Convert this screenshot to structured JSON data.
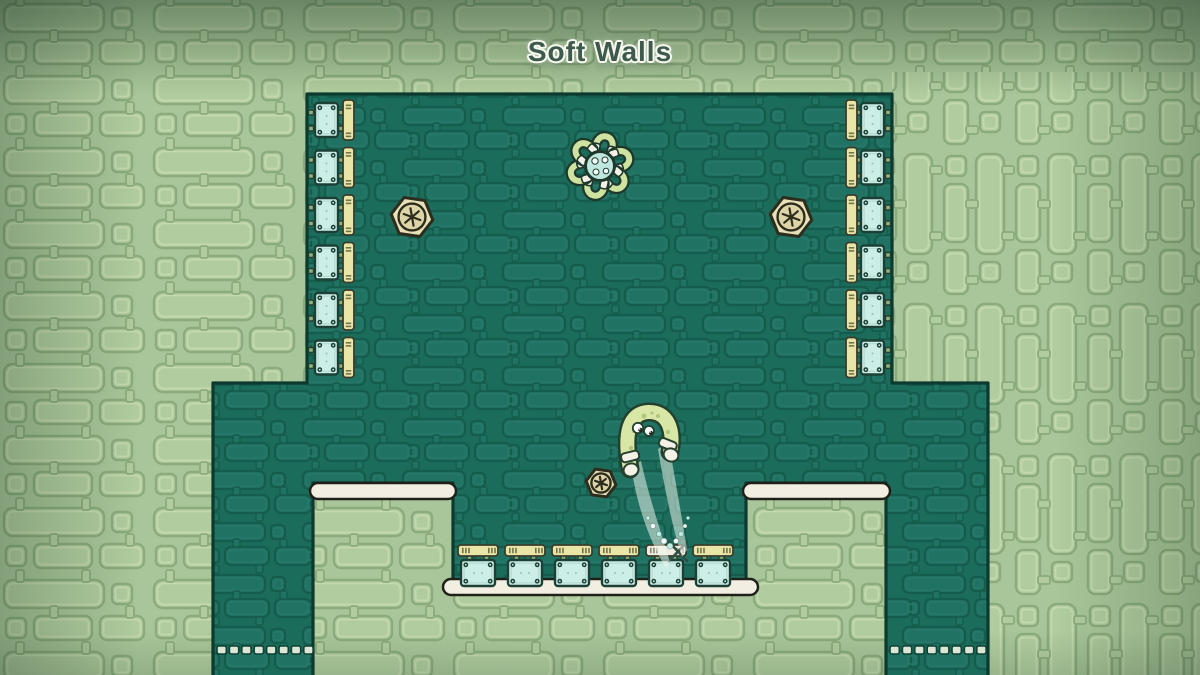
{
  "title": "Soft Walls",
  "colors": {
    "background": "#a9c69a",
    "field": "#1c6c5b",
    "outline_dark": "#0c3a2f",
    "block_fill": "#cdeee7",
    "block_border": "#1c4035",
    "tab_fill": "#e9e5a6",
    "spawn_tab_fill": "#edecdf",
    "platform_fill": "#f2efe2",
    "bolt_fill": "#e8e1b8",
    "character_body": "#d8e7a5",
    "title_color": "#3e5a4c"
  },
  "scene": {
    "left_wall_blocks": 6,
    "right_wall_blocks": 6,
    "floor_blocks": 6,
    "spawn_marker": {
      "floor_tab_index": 5,
      "symbol": "X"
    },
    "bolts": [
      {
        "x": 412,
        "y": 217,
        "size": 21
      },
      {
        "x": 791,
        "y": 217,
        "size": 21
      },
      {
        "x": 601,
        "y": 483,
        "size": 15
      }
    ],
    "grabber": {
      "x": 600,
      "y": 166,
      "legs": 6
    },
    "player": {
      "x": 650,
      "y": 440,
      "pose": "arched-jump"
    },
    "dashed_floors": [
      {
        "x": 217,
        "y": 646,
        "count": 8
      },
      {
        "x": 890,
        "y": 646,
        "count": 8
      }
    ],
    "particles": [
      {
        "x": 648,
        "y": 518,
        "r": 2.0
      },
      {
        "x": 653,
        "y": 526,
        "r": 2.5
      },
      {
        "x": 659,
        "y": 534,
        "r": 2.6
      },
      {
        "x": 664,
        "y": 541,
        "r": 3.0
      },
      {
        "x": 670,
        "y": 546,
        "r": 3.0
      },
      {
        "x": 676,
        "y": 541,
        "r": 2.6
      },
      {
        "x": 681,
        "y": 534,
        "r": 2.4
      },
      {
        "x": 685,
        "y": 526,
        "r": 2.0
      },
      {
        "x": 688,
        "y": 518,
        "r": 1.8
      }
    ]
  }
}
